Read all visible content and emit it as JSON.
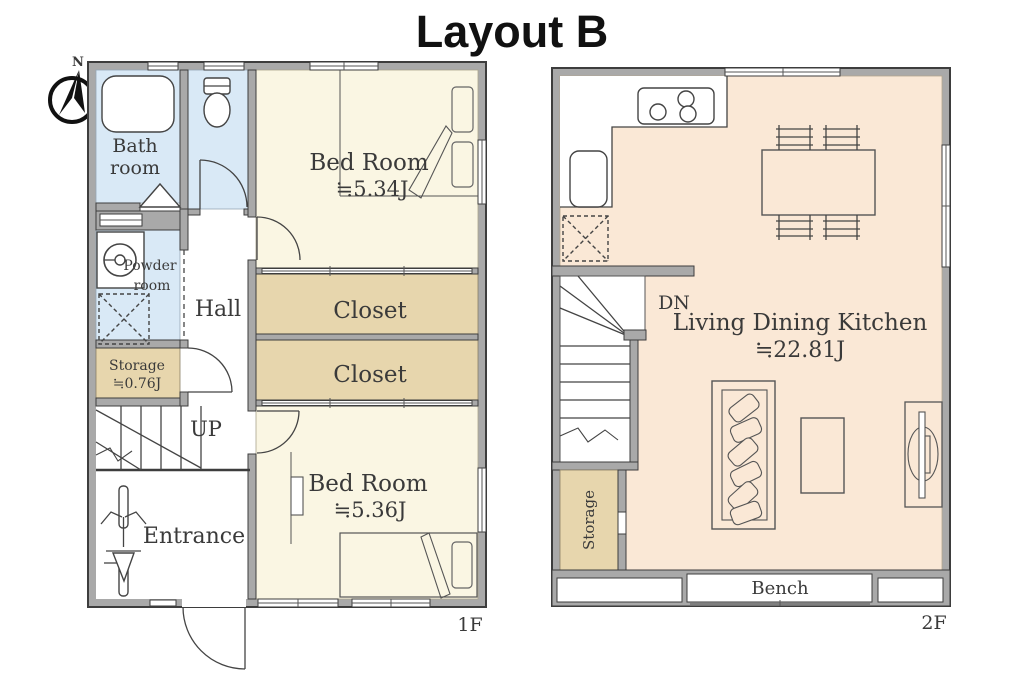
{
  "title": "Layout B",
  "compass": {
    "n": "N"
  },
  "colors": {
    "wall": "#a9a9a9",
    "water": "#d9e9f6",
    "cream": "#faf6e3",
    "closet_tan": "#e7d6ad",
    "ldk_peach": "#fae8d6"
  },
  "floor1": {
    "floor_label": "1F",
    "bathroom_line1": "Bath",
    "bathroom_line2": "room",
    "powder_line1": "Powder",
    "powder_line2": "room",
    "hall": "Hall",
    "storage": "Storage",
    "storage_area": "≒0.76J",
    "stairs": "UP",
    "entrance": "Entrance",
    "bedroom_north": "Bed Room",
    "bedroom_north_area": "≒5.34J",
    "closet_north": "Closet",
    "closet_south": "Closet",
    "bedroom_south": "Bed Room",
    "bedroom_south_area": "≒5.36J"
  },
  "floor2": {
    "floor_label": "2F",
    "stairs": "DN",
    "ldk": "Living Dining Kitchen",
    "ldk_area": "≒22.81J",
    "storage": "Storage",
    "bench": "Bench"
  }
}
